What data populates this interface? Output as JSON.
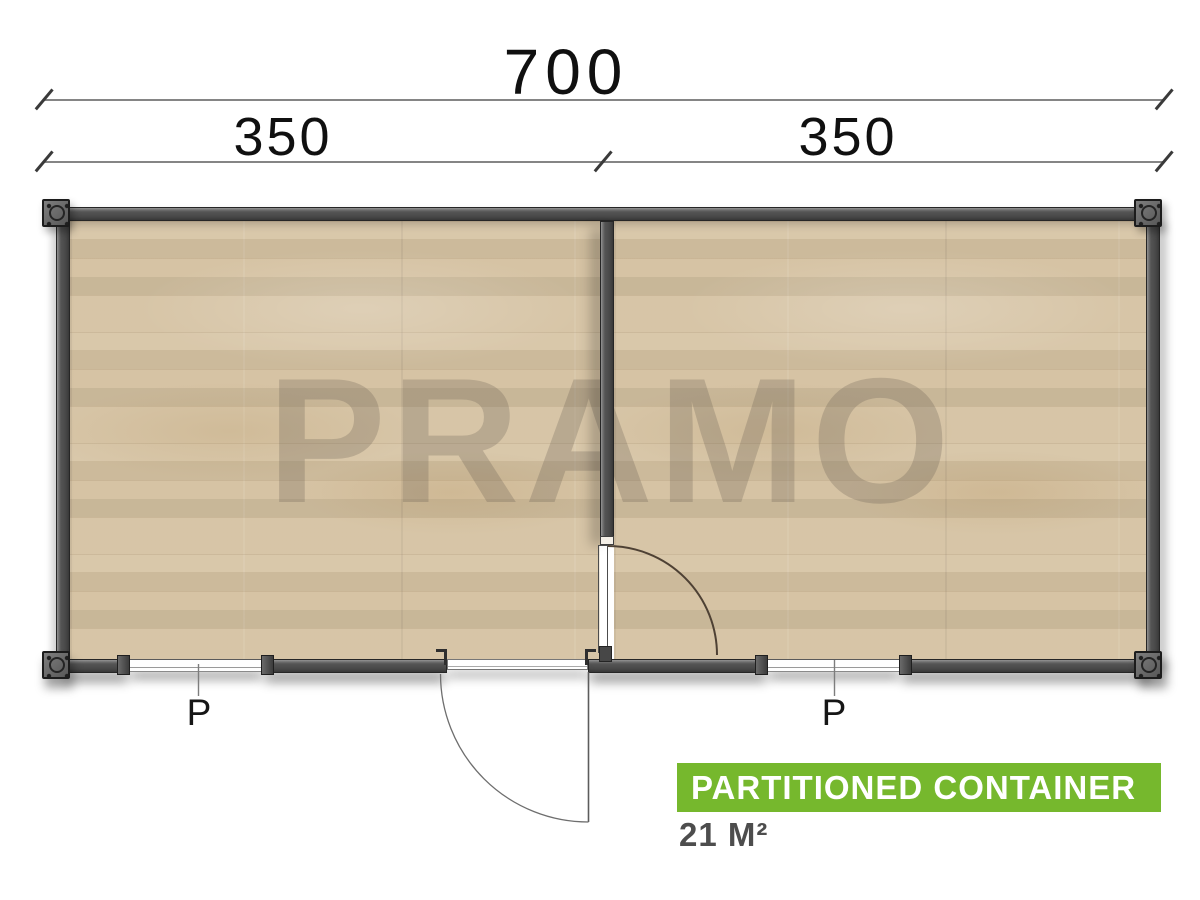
{
  "watermark": {
    "text": "PRAMO"
  },
  "dimensions": {
    "total": "700",
    "segment_left": "350",
    "segment_right": "350"
  },
  "plan": {
    "window_labels": [
      "P",
      "P"
    ]
  },
  "banner": {
    "title": "PARTITIONED CONTAINER",
    "area": "21 M²"
  },
  "colors": {
    "accent_green": "#76b82d",
    "wall_gray": "#474747",
    "floor_tan": "#d5c2a2",
    "dimension_text": "#101010"
  }
}
